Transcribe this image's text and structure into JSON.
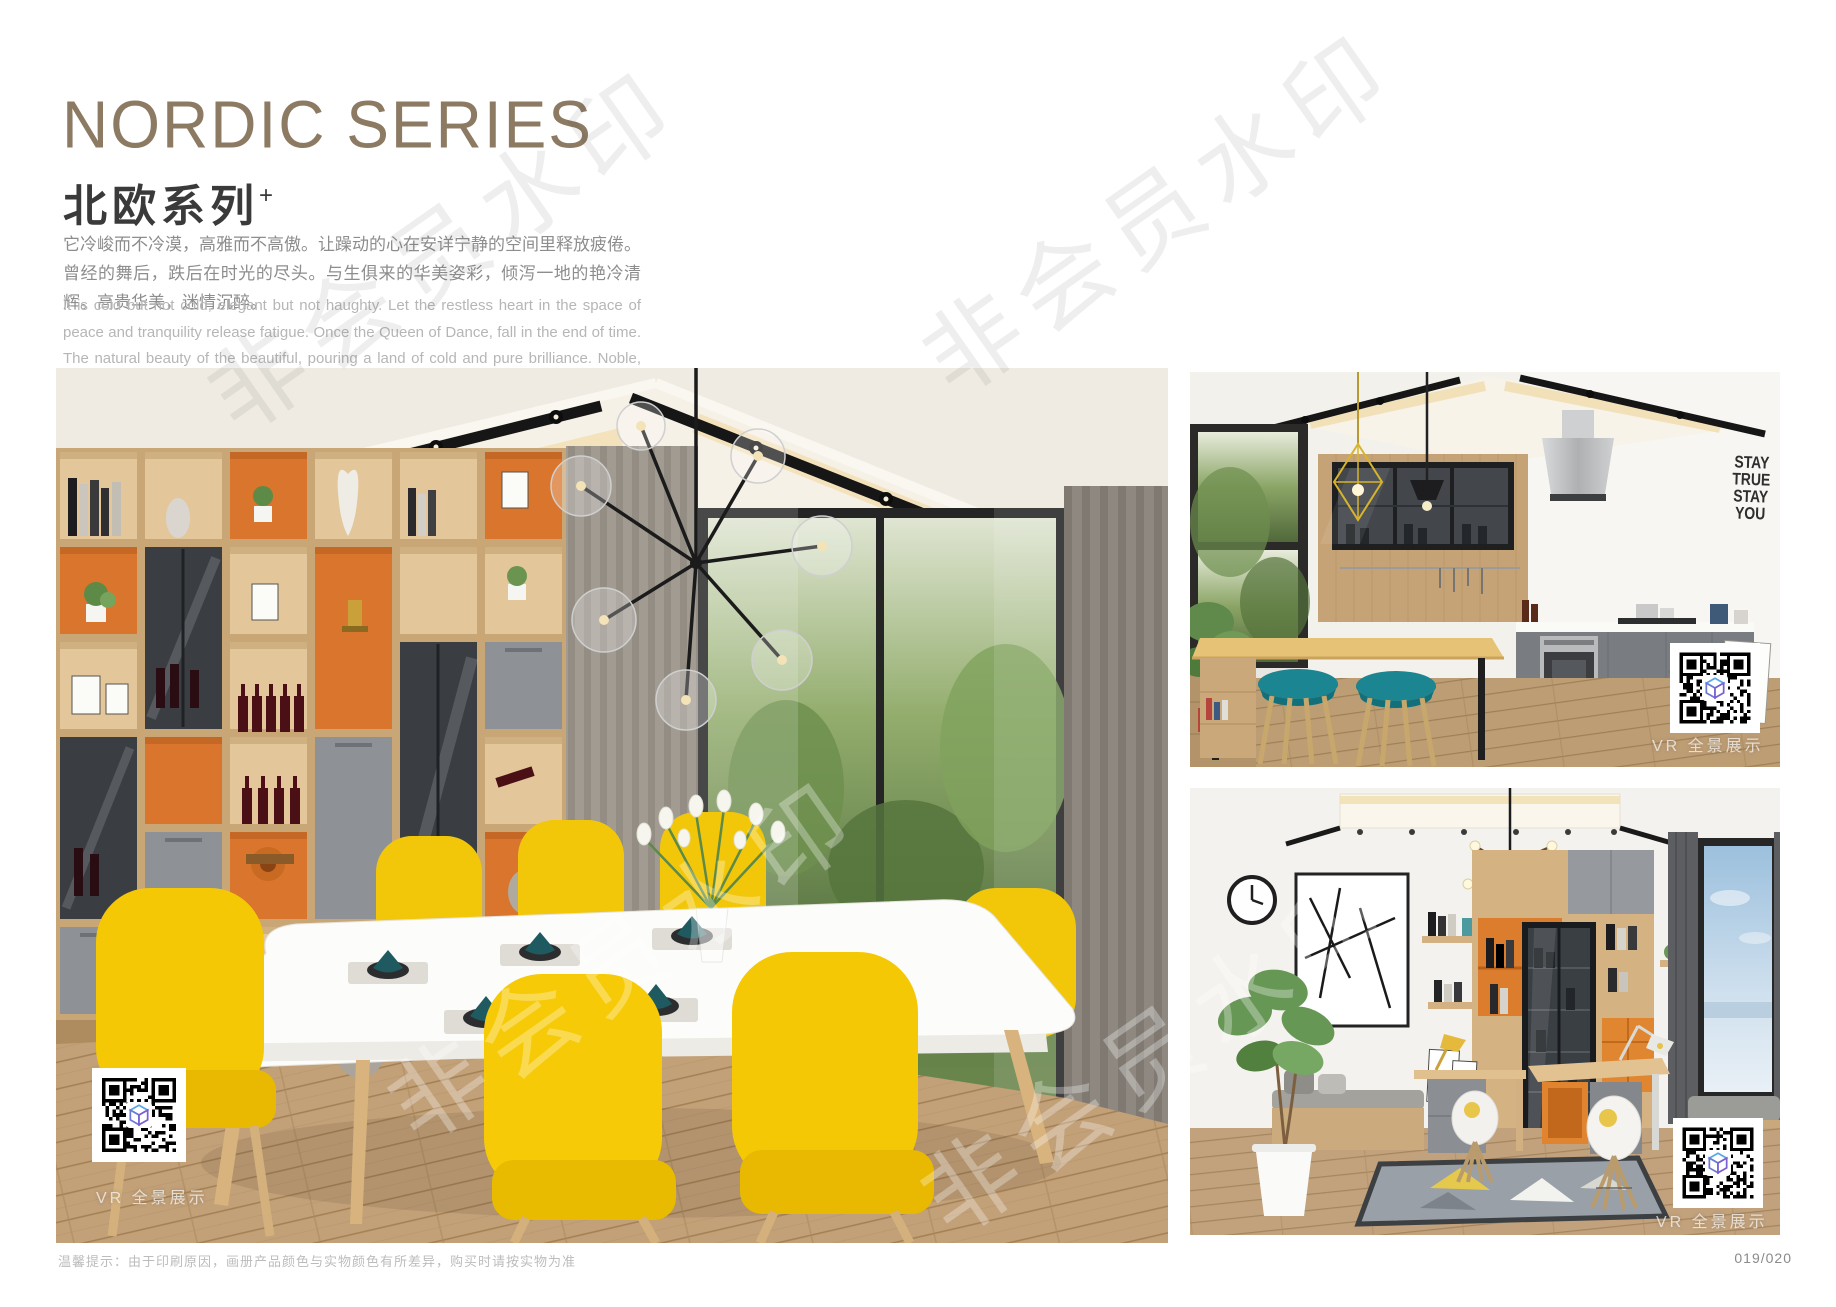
{
  "header": {
    "title_en": "NORDIC SERIES",
    "title_cn": "北欧系列",
    "title_sup": "+",
    "desc_cn": "它冷峻而不冷漠，高雅而不高傲。让躁动的心在安详宁静的空间里释放疲倦。曾经的舞后，跌后在时光的尽头。与生俱来的华美姿彩，倾泻一地的艳冷清辉。高贵华美，迷情沉醉。",
    "desc_en": "It is cold but not cold, elegant but not haughty. Let the restless heart in the space of peace and tranquility release fatigue. Once the Queen of Dance, fall in the end of time. The natural beauty of the beautiful, pouring a land of cold and pure brilliance. Noble, beautiful, enchanted."
  },
  "watermark": {
    "text": "非会员水印"
  },
  "photos": {
    "dining": {
      "name": "nordic-dining-room",
      "vr_label": "VR 全景展示"
    },
    "kitchen": {
      "name": "nordic-kitchen",
      "vr_label": "VR 全景展示",
      "wall_decal": [
        "STAY",
        "TRUE",
        "STAY",
        "YOU"
      ]
    },
    "study": {
      "name": "nordic-study",
      "vr_label": "VR 全景展示"
    }
  },
  "footer": {
    "note": "温馨提示：由于印刷原因，画册产品颜色与实物颜色有所差异，购买时请按实物为准",
    "page_number": "019/020"
  },
  "colors": {
    "title_bronze": "#8c7a63",
    "accent_orange": "#dc7a2d",
    "accent_yellow": "#f5c805",
    "accent_teal_napkin": "#1e5a5f",
    "accent_teal_stool": "#1b8591",
    "wood_light": "#d5b282",
    "cabinet_gray": "#8e9296"
  }
}
